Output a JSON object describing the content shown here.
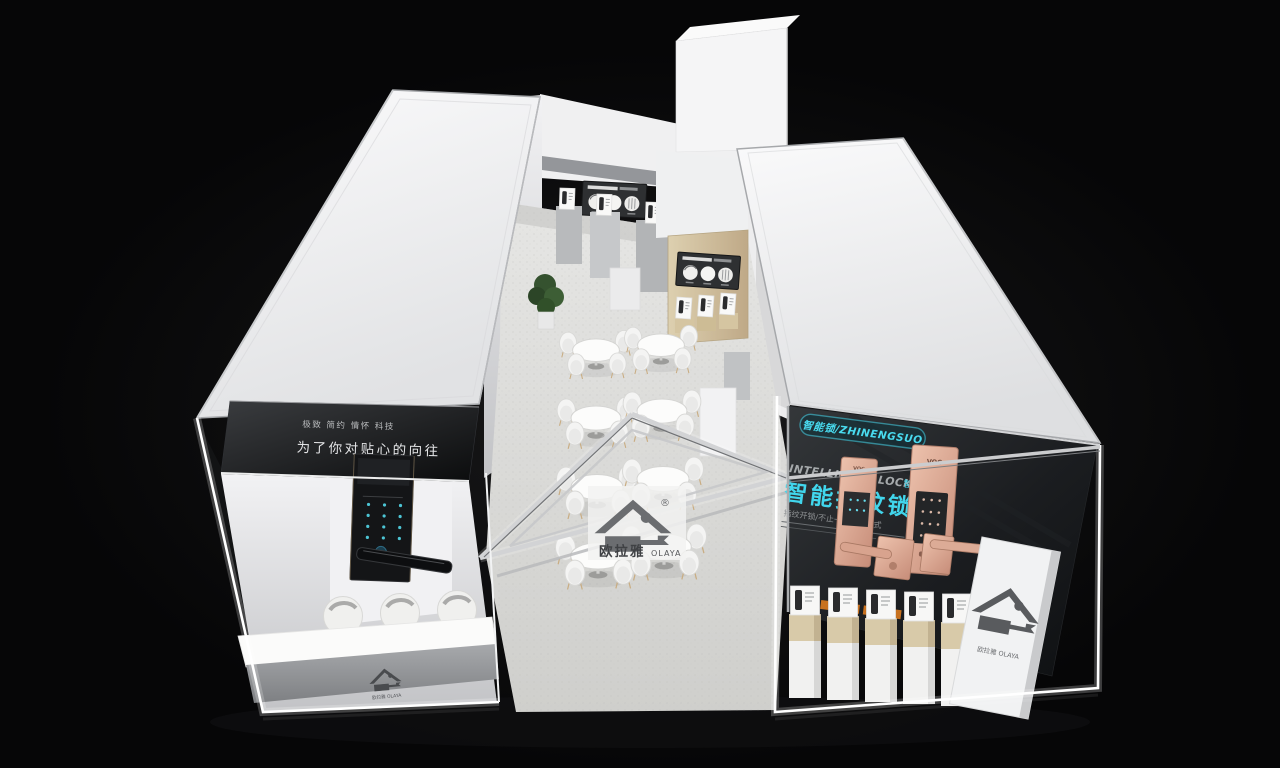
{
  "scene": {
    "description": "Isometric 3D render of a smart-lock brand exhibition booth on a black background",
    "background_color": "#060607",
    "accent_cyan": "#3fd4ea",
    "rose_gold": "#d9a38f",
    "roof_white": "#f3f3f4",
    "floor_gray": "#d9d9d6",
    "wood_tan": "#d2c3a2",
    "led_white": "#ffffff",
    "dark_wall": "#17191c"
  },
  "left_wing": {
    "slogan_small": "极致 简约 情怀 科技",
    "slogan_main": "为了你对贴心的向往"
  },
  "right_wing": {
    "badge_pill": "智能锁/ZHINENGSUO",
    "heading_en": "INTELLIGENT LOCK",
    "heading_cn_small": "智能科技",
    "heading_main": "智能指纹锁",
    "subheading": "指纹开锁/不止一种开门方式",
    "lock_brand": "VOC"
  },
  "portal": {
    "brand_cn": "欧拉雅",
    "brand_en": "OLAYA",
    "registered_mark": "®",
    "brand_lockup": "欧拉雅 OLAYA"
  }
}
